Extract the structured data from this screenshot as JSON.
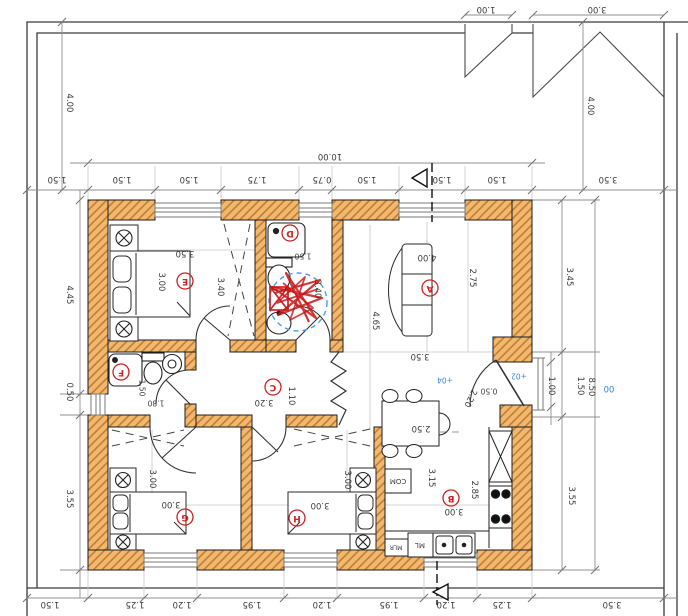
{
  "drawing": {
    "type": "architectural-floor-plan-rotated-180",
    "colors": {
      "wall_fill": "#f3b870",
      "wall_hatch": "#b97a2e",
      "dim_text": "#3b3b3b",
      "marker_red": "#cc2222",
      "level_blue": "#2e86e0",
      "dim_line": "#909090"
    },
    "room_markers": [
      {
        "letter": "A",
        "x": 430,
        "y": 288
      },
      {
        "letter": "B",
        "x": 451,
        "y": 498
      },
      {
        "letter": "C",
        "x": 273,
        "y": 387
      },
      {
        "letter": "D",
        "x": 290,
        "y": 233
      },
      {
        "letter": "E",
        "x": 185,
        "y": 281
      },
      {
        "letter": "F",
        "x": 121,
        "y": 372
      },
      {
        "letter": "G",
        "x": 185,
        "y": 517
      },
      {
        "letter": "H",
        "x": 297,
        "y": 518
      }
    ],
    "dimension_labels": [
      {
        "t": "1.00",
        "x": 486,
        "y": 9,
        "r": 180
      },
      {
        "t": "3.00",
        "x": 597,
        "y": 9,
        "r": 180
      },
      {
        "t": "4.00",
        "x": 590,
        "y": 106,
        "r": 90
      },
      {
        "t": "4.00",
        "x": 69,
        "y": 103,
        "r": 90
      },
      {
        "t": "10.00",
        "x": 330,
        "y": 156,
        "r": 180
      },
      {
        "t": "1.50",
        "x": 57,
        "y": 179,
        "r": 180
      },
      {
        "t": "1.50",
        "x": 122,
        "y": 179,
        "r": 180
      },
      {
        "t": "1.50",
        "x": 189,
        "y": 179,
        "r": 180
      },
      {
        "t": "1.75",
        "x": 257,
        "y": 179,
        "r": 180
      },
      {
        "t": "0.75",
        "x": 322,
        "y": 179,
        "r": 180
      },
      {
        "t": "1.50",
        "x": 367,
        "y": 179,
        "r": 180
      },
      {
        "t": "1.50",
        "x": 442,
        "y": 179,
        "r": 180
      },
      {
        "t": "1.50",
        "x": 497,
        "y": 179,
        "r": 180
      },
      {
        "t": "3.50",
        "x": 608,
        "y": 179,
        "r": 180
      },
      {
        "t": "1.50",
        "x": 50,
        "y": 604,
        "r": 180
      },
      {
        "t": "1.25",
        "x": 135,
        "y": 604,
        "r": 180
      },
      {
        "t": "1.20",
        "x": 182,
        "y": 604,
        "r": 180
      },
      {
        "t": "1.95",
        "x": 252,
        "y": 604,
        "r": 180
      },
      {
        "t": "1.20",
        "x": 322,
        "y": 604,
        "r": 180
      },
      {
        "t": "1.95",
        "x": 389,
        "y": 604,
        "r": 180
      },
      {
        "t": "1.20",
        "x": 446,
        "y": 604,
        "r": 180
      },
      {
        "t": "1.25",
        "x": 502,
        "y": 604,
        "r": 180
      },
      {
        "t": "3.50",
        "x": 612,
        "y": 604,
        "r": 180
      },
      {
        "t": "4.45",
        "x": 69,
        "y": 295,
        "r": 90
      },
      {
        "t": "0.50",
        "x": 69,
        "y": 392,
        "r": 90
      },
      {
        "t": "3.55",
        "x": 69,
        "y": 499,
        "r": 90
      },
      {
        "t": "3.45",
        "x": 569,
        "y": 277,
        "r": 90
      },
      {
        "t": "1.00",
        "x": 551,
        "y": 386,
        "r": 90
      },
      {
        "t": "1.50",
        "x": 580,
        "y": 386,
        "r": 90
      },
      {
        "t": "8.50",
        "x": 591,
        "y": 387,
        "r": 90
      },
      {
        "t": "3.55",
        "x": 571,
        "y": 496,
        "r": 90
      },
      {
        "t": "00",
        "x": 609,
        "y": 388,
        "r": 180,
        "c": "#2e86e0"
      },
      {
        "t": "+02",
        "x": 519,
        "y": 376,
        "r": 180,
        "c": "#2e86e0",
        "fs": 7.5
      },
      {
        "t": "+04",
        "x": 445,
        "y": 380,
        "r": 180,
        "c": "#2e86e0",
        "fs": 7.5
      },
      {
        "t": "0.50",
        "x": 489,
        "y": 391,
        "r": 180,
        "fs": 7.5
      },
      {
        "t": "2.20",
        "x": 470,
        "y": 398,
        "r": 115
      },
      {
        "t": "3.50",
        "x": 185,
        "y": 253,
        "r": 180
      },
      {
        "t": "3.00",
        "x": 161,
        "y": 282,
        "r": 90
      },
      {
        "t": "3.40",
        "x": 220,
        "y": 287,
        "r": 90
      },
      {
        "t": "1.50",
        "x": 303,
        "y": 256,
        "r": 180,
        "fs": 7.5
      },
      {
        "t": "3.40",
        "x": 317,
        "y": 289,
        "r": 90
      },
      {
        "t": "4.00",
        "x": 427,
        "y": 257,
        "r": 180
      },
      {
        "t": "2.75",
        "x": 472,
        "y": 278,
        "r": 90
      },
      {
        "t": "4.65",
        "x": 375,
        "y": 321,
        "r": 90
      },
      {
        "t": "3.50",
        "x": 420,
        "y": 356,
        "r": 180
      },
      {
        "t": "3.20",
        "x": 264,
        "y": 402,
        "r": 180
      },
      {
        "t": "1.10",
        "x": 291,
        "y": 396,
        "r": 90
      },
      {
        "t": "1.50",
        "x": 142,
        "y": 388,
        "r": 90,
        "fs": 7.5
      },
      {
        "t": "1.80",
        "x": 156,
        "y": 403,
        "r": 180,
        "fs": 7.5
      },
      {
        "t": "3.00",
        "x": 152,
        "y": 479,
        "r": 90
      },
      {
        "t": "3.00",
        "x": 171,
        "y": 504,
        "r": 180
      },
      {
        "t": "3.00",
        "x": 347,
        "y": 480,
        "r": 90
      },
      {
        "t": "3.00",
        "x": 320,
        "y": 505,
        "r": 180
      },
      {
        "t": "2.50",
        "x": 421,
        "y": 428,
        "r": 180
      },
      {
        "t": "3.15",
        "x": 431,
        "y": 478,
        "r": 90
      },
      {
        "t": "2.85",
        "x": 474,
        "y": 490,
        "r": 90
      },
      {
        "t": "3.00",
        "x": 454,
        "y": 511,
        "r": 180
      }
    ],
    "equipment_labels": [
      {
        "t": "COM",
        "x": 398,
        "y": 481,
        "r": 180,
        "fs": 7
      },
      {
        "t": "MLR",
        "x": 396,
        "y": 547,
        "r": 180,
        "fs": 6
      },
      {
        "t": "ML",
        "x": 420,
        "y": 545,
        "r": 180,
        "fs": 7
      }
    ]
  }
}
